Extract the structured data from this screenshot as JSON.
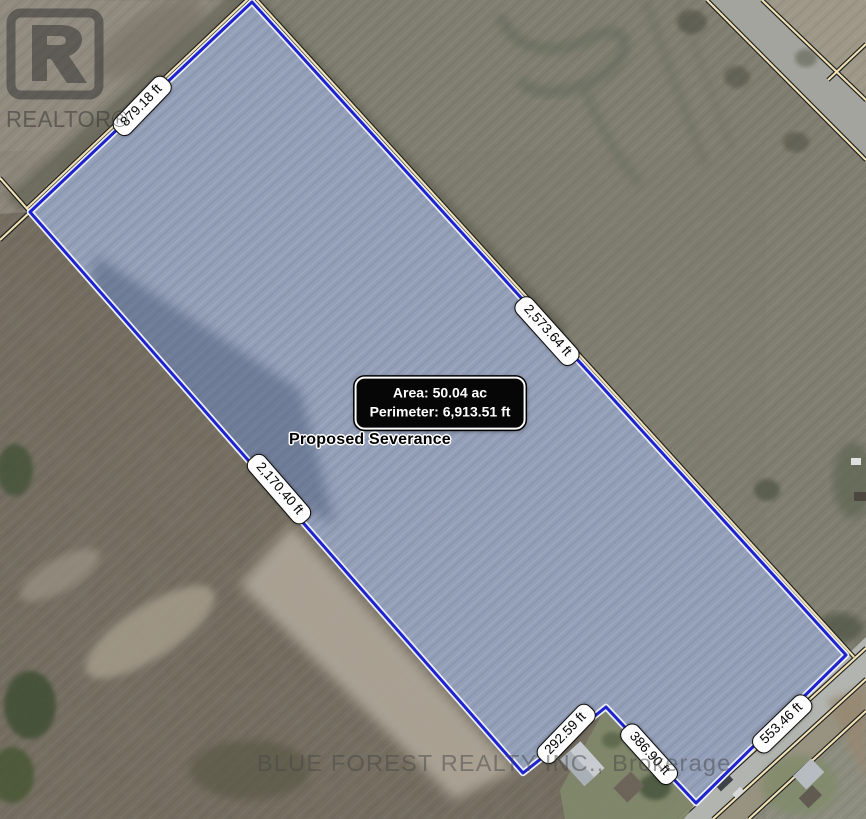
{
  "map": {
    "edge_labels": {
      "top": "879.18 ft",
      "right": "2,573.64 ft",
      "left": "2,170.40 ft",
      "bottom_left": "292.59 ft",
      "bottom_middle": "386.90 ft",
      "bottom_right": "553.46 ft"
    },
    "info_box": {
      "area": "Area: 50.04 ac",
      "perimeter": "Perimeter: 6,913.51 ft"
    },
    "parcel_label": "Proposed Severance"
  },
  "watermarks": {
    "realtor_logo_text": "REALTOR®",
    "brokerage": "BLUE FOREST REALTY INC., Brokerage"
  },
  "colors": {
    "boundary_blue": "#1a1fd0",
    "fabric_line_tan": "#f2e3b5",
    "parcel_fill": "#93a0bb",
    "info_box_bg": "#060606",
    "info_box_text": "#ffffff"
  }
}
